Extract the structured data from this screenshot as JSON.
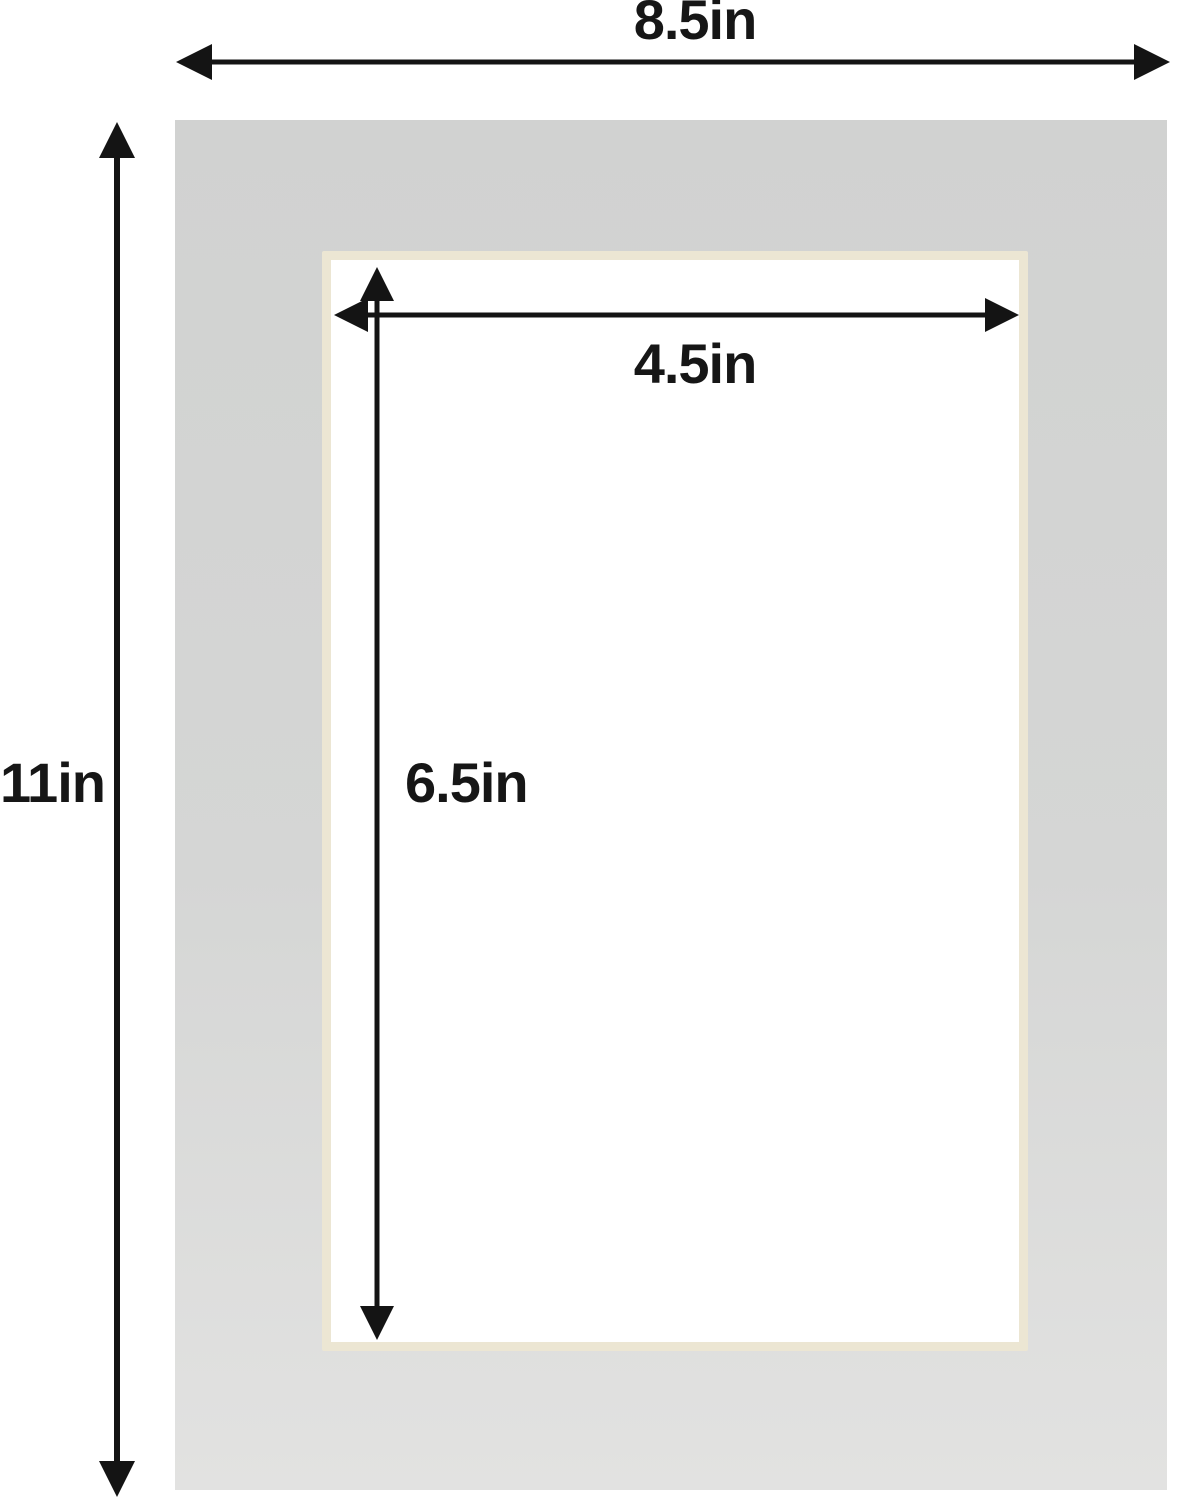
{
  "diagram": {
    "title": "Mat board dimension diagram",
    "dimensions": {
      "overall_width": "8.5in",
      "overall_height": "11in",
      "opening_width": "4.5in",
      "opening_height": "6.5in"
    },
    "colors": {
      "background": "#ffffff",
      "mat_surface": "#d3d4d3",
      "mat_surface_light": "#e2e2e1",
      "bevel_edge": "#ece6d3",
      "opening": "#ffffff",
      "dimension_lines": "#141414",
      "label_text": "#161616"
    }
  }
}
